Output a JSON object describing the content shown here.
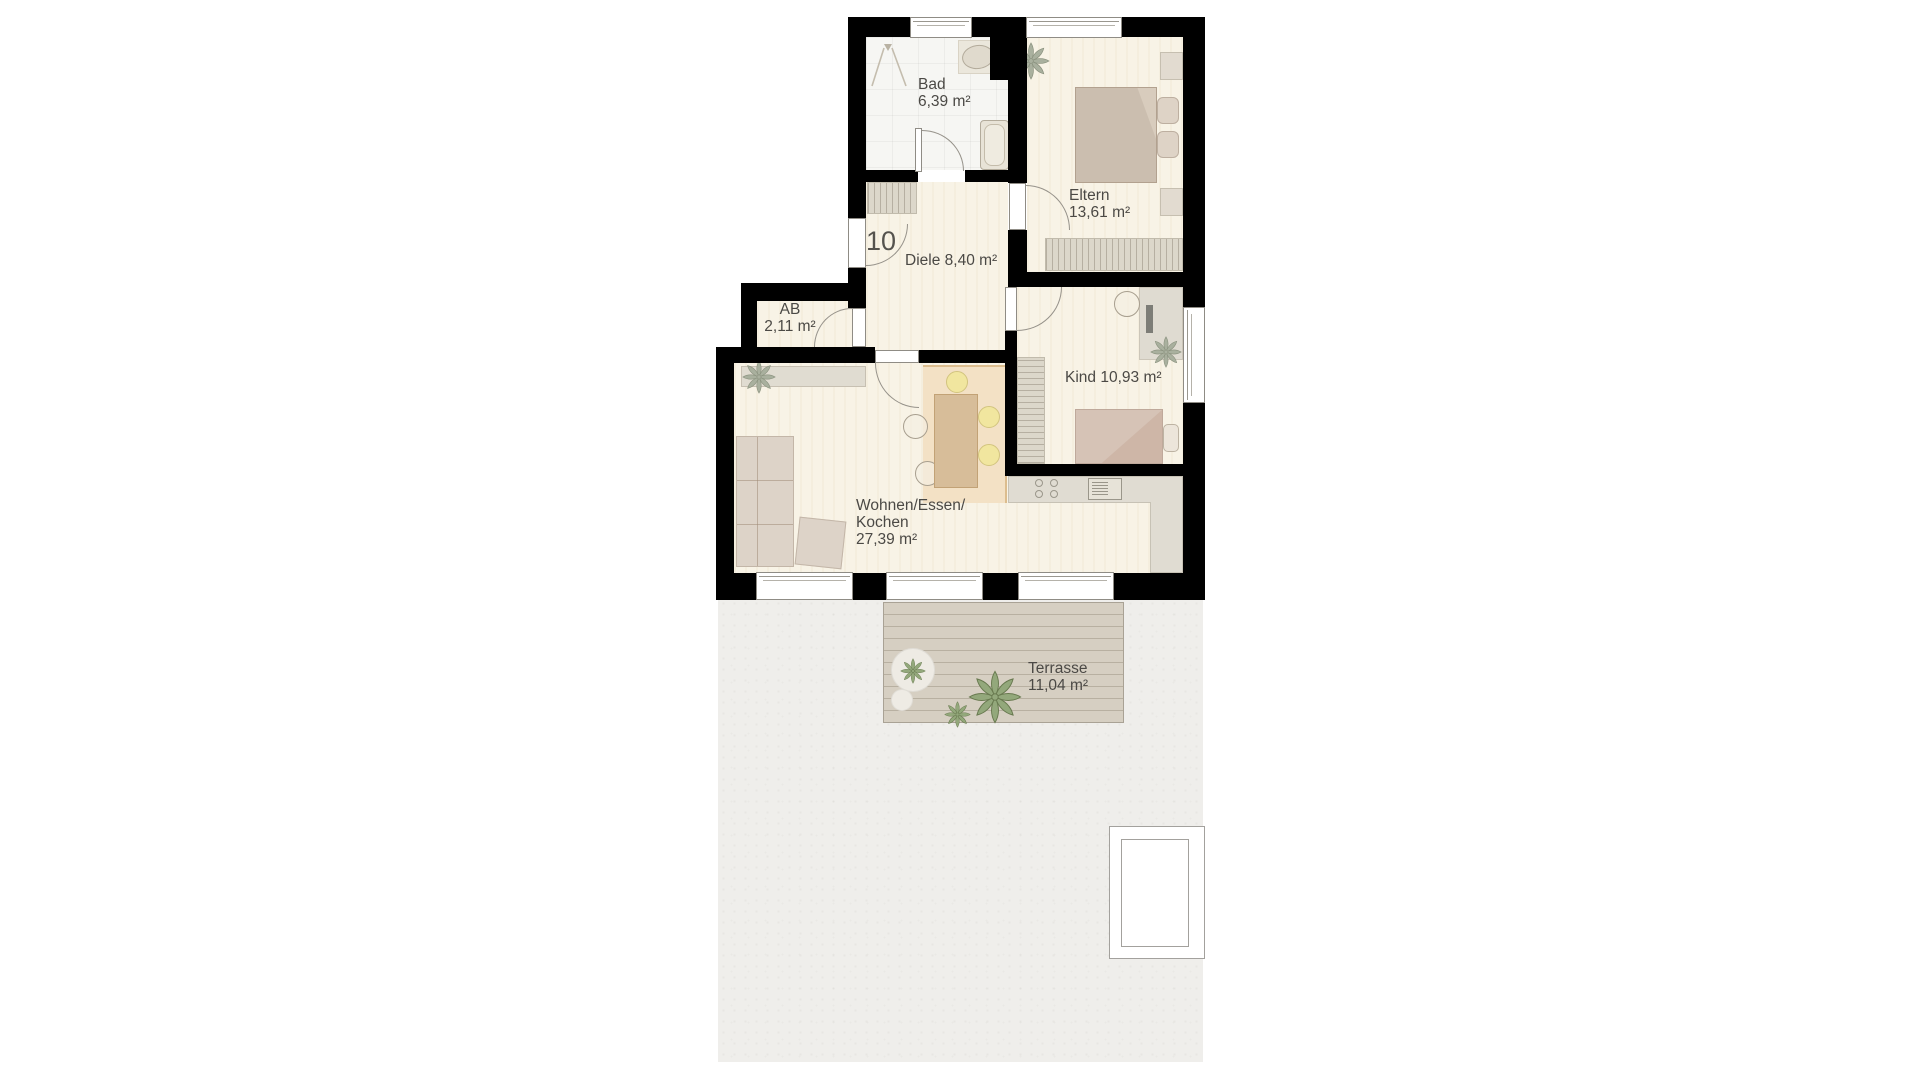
{
  "unit": {
    "number": "10"
  },
  "rooms": {
    "bad": {
      "name": "Bad",
      "area": "6,39 m²"
    },
    "eltern": {
      "name": "Eltern",
      "area": "13,61 m²"
    },
    "diele": {
      "name": "Diele",
      "area": "8,40 m²"
    },
    "ab": {
      "name": "AB",
      "area": "2,11 m²"
    },
    "kind": {
      "name": "Kind",
      "area": "10,93 m²"
    },
    "wohnen": {
      "name_line1": "Wohnen/Essen/",
      "name_line2": "Kochen",
      "area": "27,39 m²"
    },
    "terrasse": {
      "name": "Terrasse",
      "area": "11,04 m²"
    }
  },
  "colors": {
    "wall": "#000000",
    "wood_floor": "#f8f3e6",
    "tile_floor": "#f6f6f3",
    "kitchen_floor": "#f3e1c5",
    "counter": "#e0dcd2",
    "stool_yellow": "#f1e69f",
    "plant_green": "#93a87b",
    "plant_gray": "#a9b09e",
    "deck": "#d6cfc2",
    "ground": "#efeeeb",
    "label_text": "#4b4945"
  }
}
